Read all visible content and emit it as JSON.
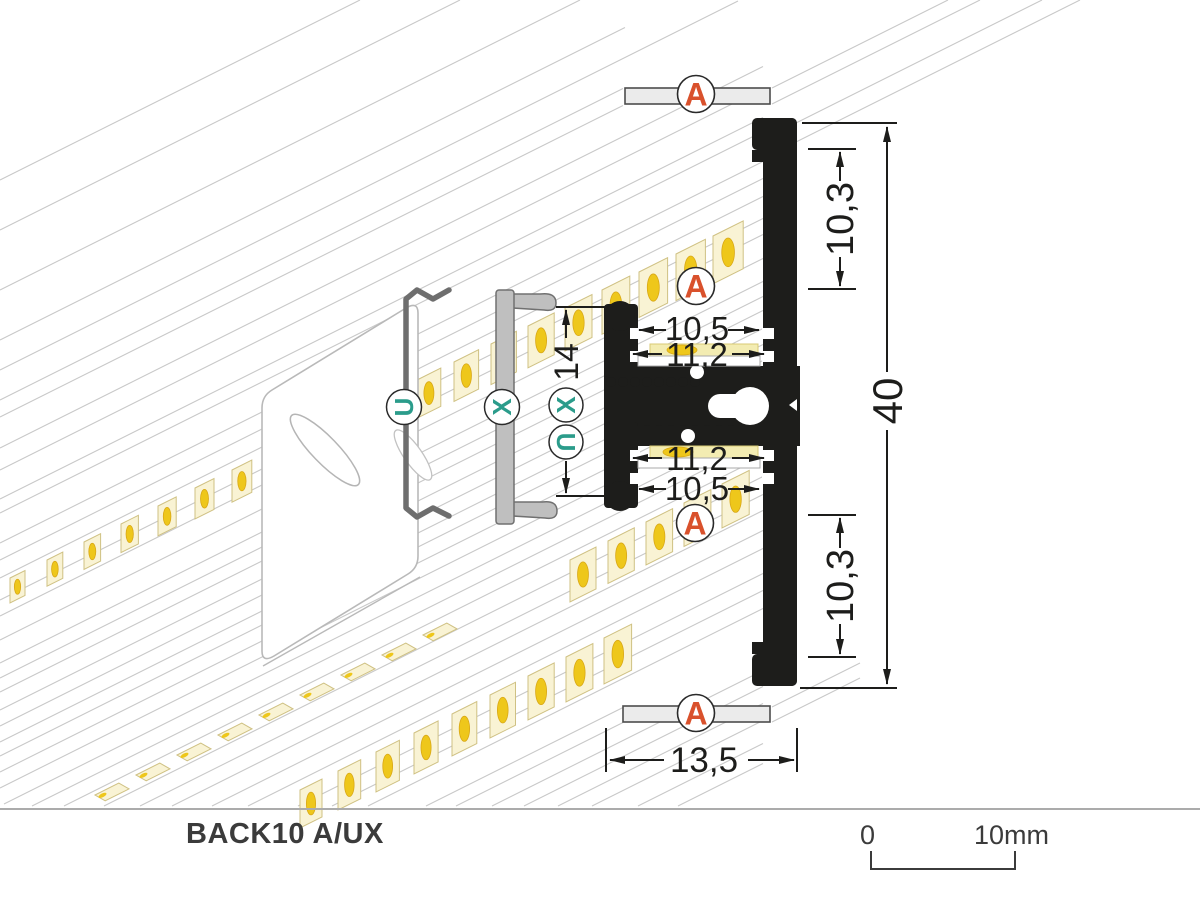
{
  "title": {
    "model": "BACK10 A/UX"
  },
  "scale": {
    "start": "0",
    "end": "10mm"
  },
  "dims": {
    "upper_flange_height": "10,3",
    "lower_flange_height": "10,3",
    "total_height": "40",
    "bottom_width": "13,5",
    "upper_slot_opening": "10,5",
    "upper_slot_width": "11,2",
    "lower_slot_width": "11,2",
    "lower_slot_opening": "10,5",
    "bracket_depth": "14"
  },
  "markers": {
    "cover": "A",
    "clip": "U",
    "bracket": "X"
  },
  "colors": {
    "accent_orange": "#d9512c",
    "accent_teal": "#2b9c8b",
    "profile_black": "#1d1d1b",
    "line_gray": "#c9c9c9",
    "chip_body": "#f9f3d4",
    "chip_stroke": "#cfc183",
    "chip_gold": "#eec71b",
    "chip_gold_stroke": "#d9a816",
    "tape_yellow": "#f3ecb2",
    "cover_fill": "#ebebeb",
    "steel_gray": "#bfbfbf",
    "clip_gray": "#6e6e6e"
  },
  "drawing": {
    "iso_lines": [
      [
        180,
        0,
        360
      ],
      [
        230,
        0,
        460
      ],
      [
        290,
        0,
        580
      ],
      [
        340,
        0,
        625
      ],
      [
        370,
        0,
        738
      ],
      [
        400,
        0,
        623
      ],
      [
        417,
        0,
        623
      ],
      [
        448,
        0,
        763
      ],
      [
        470,
        0,
        763
      ],
      [
        499,
        0,
        763
      ],
      [
        513,
        0,
        763
      ],
      [
        543,
        0,
        763
      ],
      [
        560,
        0,
        763
      ],
      [
        578,
        0,
        763
      ],
      [
        600,
        0,
        763
      ],
      [
        616,
        0,
        763
      ],
      [
        640,
        0,
        763
      ],
      [
        663,
        0,
        763
      ],
      [
        678,
        0,
        763
      ],
      [
        692,
        0,
        763
      ],
      [
        710,
        0,
        763
      ],
      [
        726,
        0,
        763
      ],
      [
        742,
        0,
        763
      ],
      [
        756,
        0,
        763
      ],
      [
        772,
        0,
        763
      ],
      [
        788,
        0,
        763
      ],
      [
        806,
        4,
        763
      ],
      [
        822,
        32,
        763
      ],
      [
        838,
        64,
        763
      ],
      [
        858,
        104,
        763
      ],
      [
        876,
        140,
        763
      ],
      [
        892,
        172,
        763
      ],
      [
        912,
        212,
        763
      ],
      [
        930,
        248,
        763
      ],
      [
        955,
        298,
        763
      ],
      [
        972,
        332,
        763
      ],
      [
        990,
        368,
        763
      ],
      [
        1019,
        426,
        623
      ],
      [
        1034,
        456,
        623
      ],
      [
        1052,
        492,
        763
      ],
      [
        1068,
        524,
        763
      ],
      [
        1085,
        558,
        763
      ],
      [
        1102,
        592,
        763
      ],
      [
        1125,
        638,
        763
      ],
      [
        1145,
        678,
        763
      ],
      [
        474,
        772,
        948
      ],
      [
        490,
        772,
        980
      ],
      [
        521,
        797,
        1042
      ],
      [
        540,
        797,
        1080
      ],
      [
        1093,
        772,
        860
      ],
      [
        1108,
        772,
        860
      ]
    ],
    "led_rows": [
      {
        "name": "upper-led-strip",
        "style": "face",
        "x": 10,
        "y": 578,
        "dx": 37,
        "dy": -18,
        "count": 20,
        "w": 15,
        "h": 25,
        "gw": 0.8,
        "gh": 1.2
      },
      {
        "name": "rear-led-strip-flat",
        "style": "flat",
        "x": 95,
        "y": 795,
        "dx": 41,
        "dy": -20,
        "count": 9,
        "w": 34
      },
      {
        "name": "front-led-strip",
        "style": "face",
        "x": 300,
        "y": 790,
        "dx": 38,
        "dy": -19,
        "count": 9,
        "w": 22,
        "h": 38,
        "gw": 0.7,
        "gh": 1.0
      },
      {
        "name": "lower-led-strip-section",
        "style": "face",
        "x": 570,
        "y": 560,
        "dx": 38,
        "dy": -19,
        "count": 5,
        "w": 26,
        "h": 42,
        "gw": 0.3,
        "gh": 0.5
      }
    ]
  }
}
